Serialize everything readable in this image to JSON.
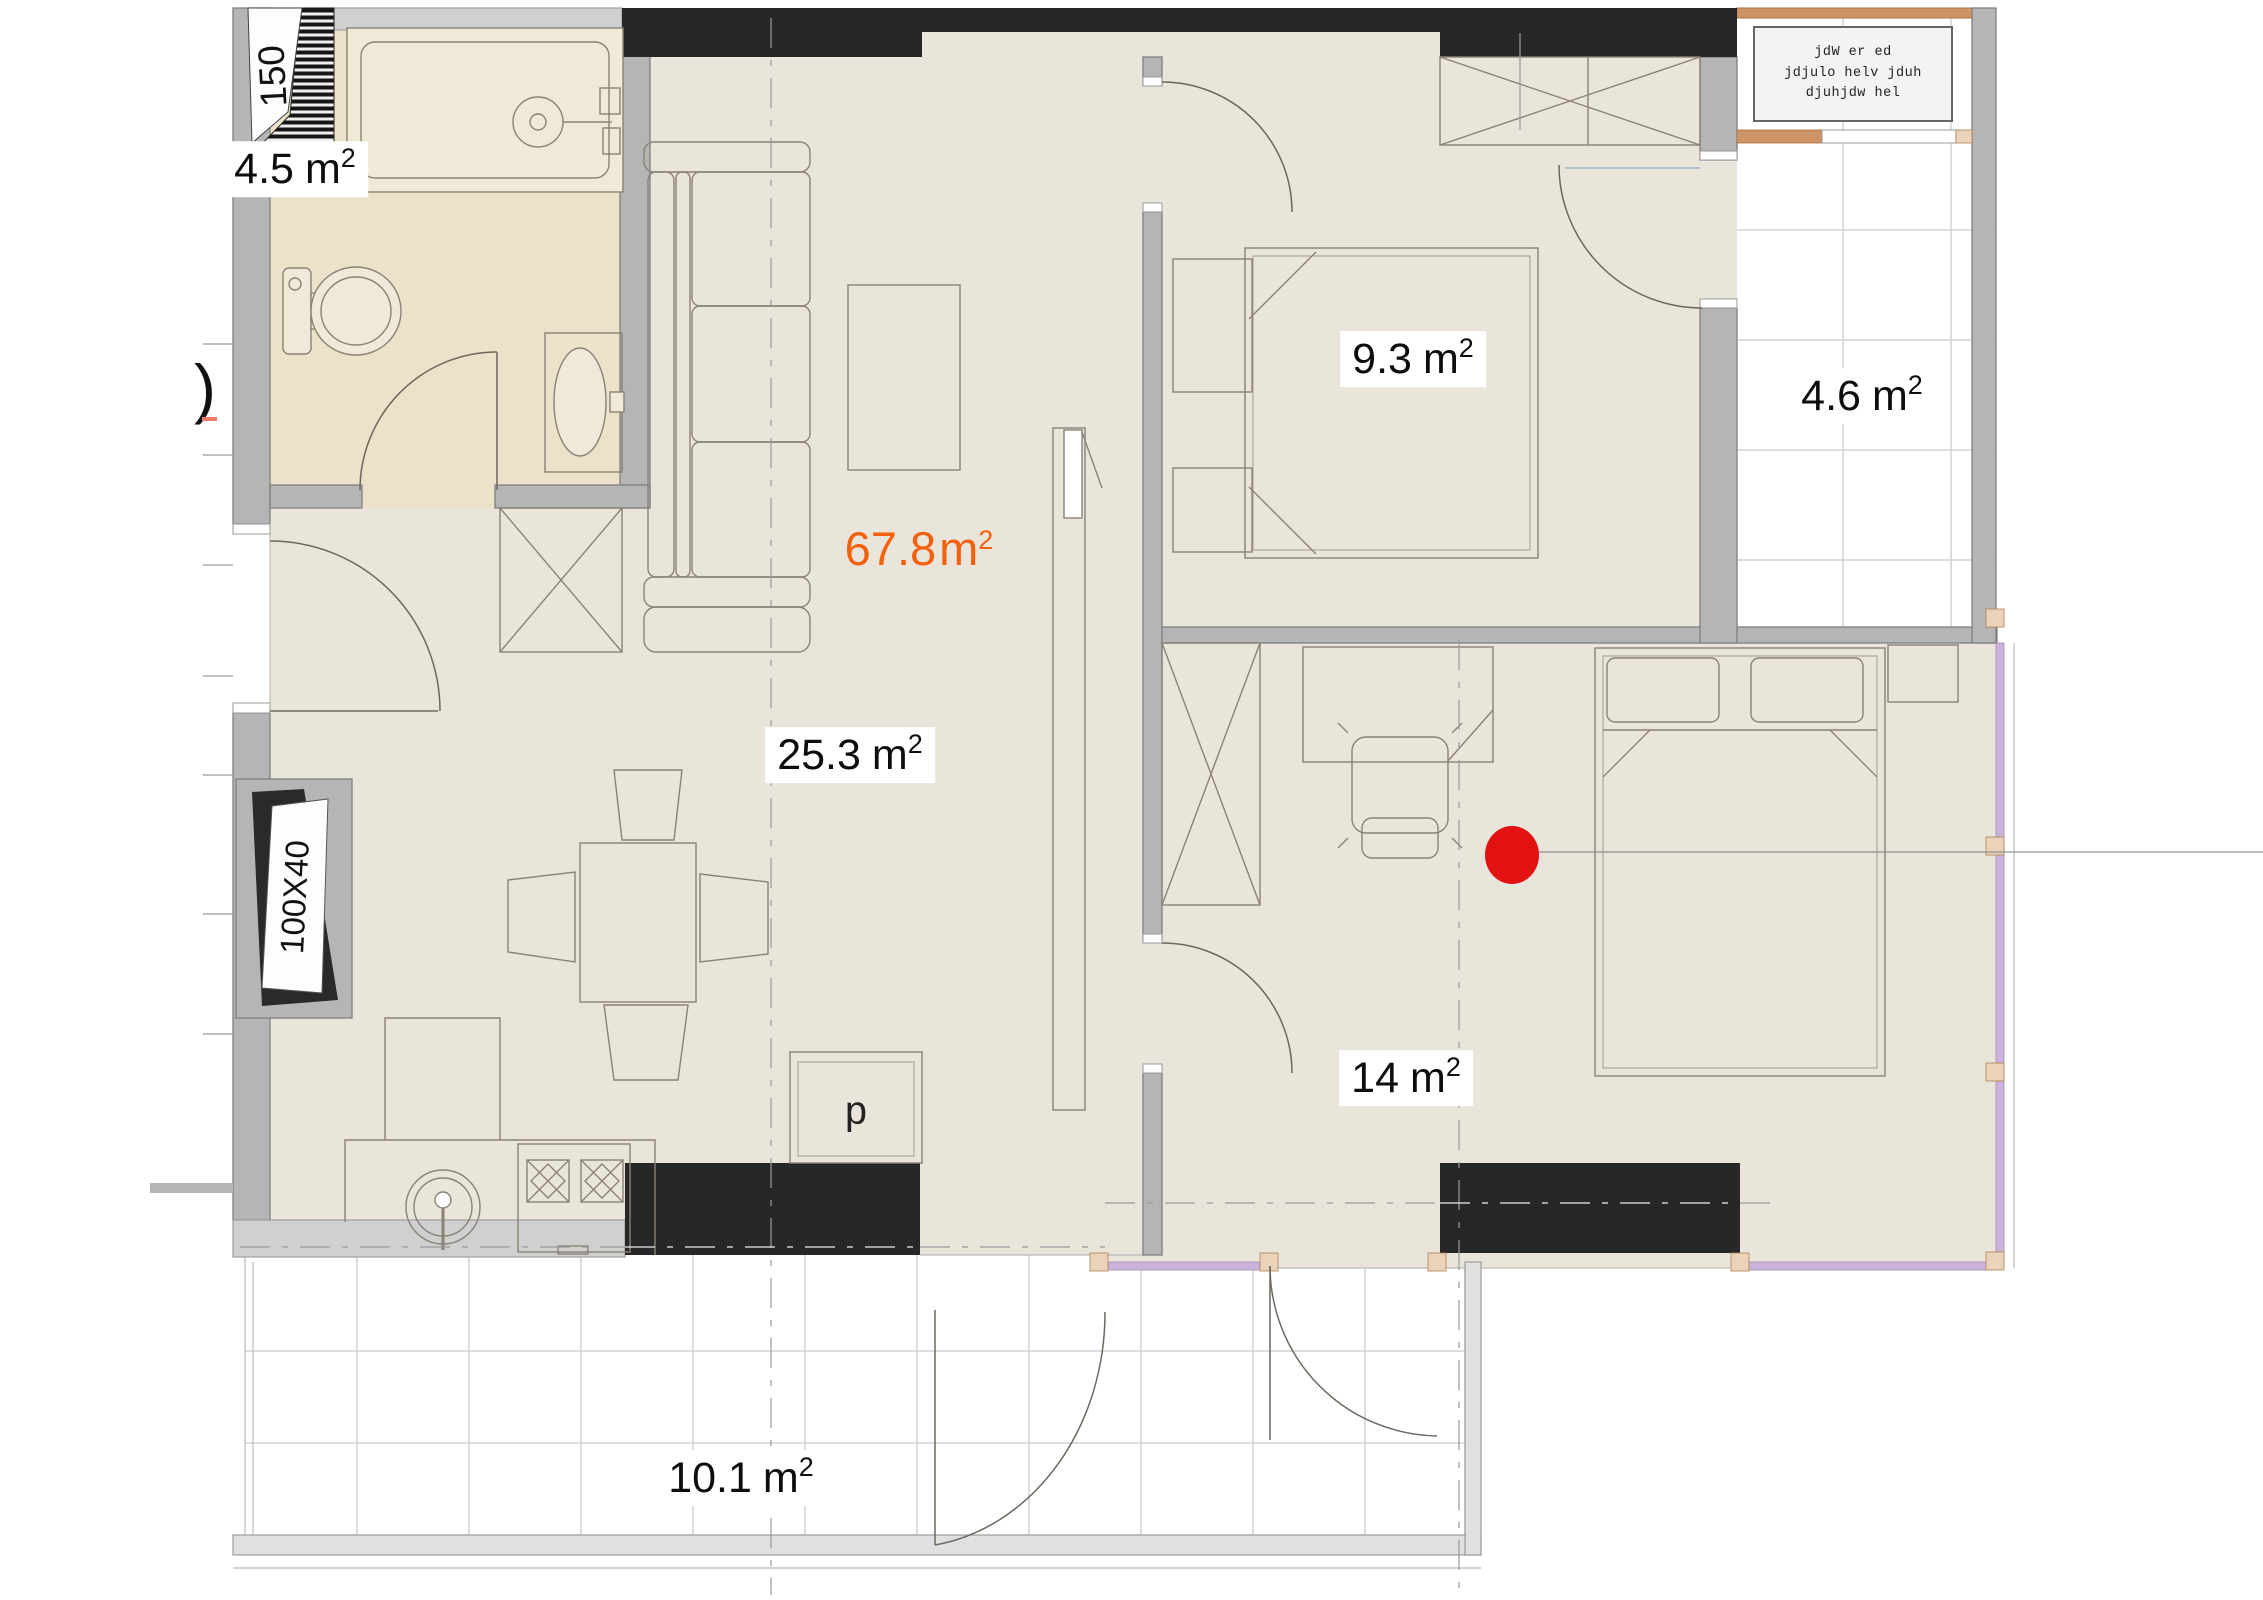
{
  "plan": {
    "labels": {
      "rooms": [
        {
          "id": "bathroom",
          "value": "4.5",
          "unit": "m",
          "sup": "2"
        },
        {
          "id": "living-room",
          "value": "25.3",
          "unit": "m",
          "sup": "2"
        },
        {
          "id": "bedroom-small",
          "value": "9.3",
          "unit": "m",
          "sup": "2"
        },
        {
          "id": "bedroom-large",
          "value": "14",
          "unit": "m",
          "sup": "2"
        },
        {
          "id": "balcony-side",
          "value": "4.6",
          "unit": "m",
          "sup": "2"
        },
        {
          "id": "balcony-bottom",
          "value": "10.1",
          "unit": "m",
          "sup": "2"
        }
      ],
      "total": {
        "value": "67.8",
        "unit": "m",
        "sup": "2"
      },
      "window_marker_top": "150",
      "window_marker_left": "100X40",
      "pantry": "p",
      "dim_fragment": ")",
      "note_lines": [
        "jdW er ed",
        "jdjulo helv jduh",
        "djuhjdw hel"
      ]
    },
    "colors": {
      "floor_main": "#eae5da",
      "floor_bath": "#ece2c9",
      "wall_gray": "#b5b5b5",
      "wall_black": "#272727",
      "accent_total": "#f4610e",
      "marker_red": "#e31212",
      "window_lavender": "#c9b3da",
      "railing_tan": "#cf9465",
      "balcony_grid": "#d2d2d2"
    }
  }
}
